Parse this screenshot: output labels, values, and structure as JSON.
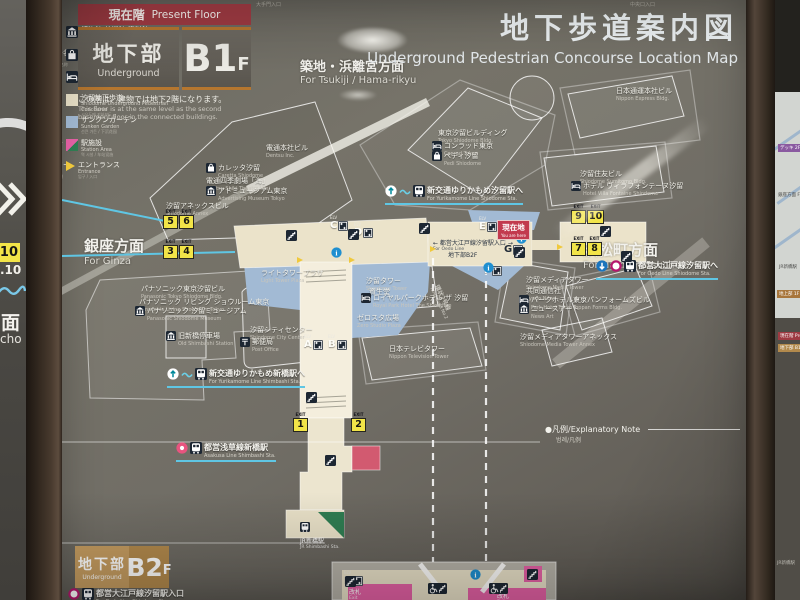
{
  "colors": {
    "concourse_beige": "#ebe3ca",
    "sunken_blue": "#a2bad4",
    "station_pink": "#e561a5",
    "jr_green": "#2f7d52",
    "exit_yellow": "#f2e448",
    "banner_red": "#9e3a42",
    "b2_tan": "#c59c60",
    "line_cyan": "#5fc6e4",
    "oedo_magenta": "#b5176d"
  },
  "sign": {
    "present_floor": {
      "jp": "現在階",
      "en": "Present Floor"
    },
    "floor_badge": {
      "name_jp": "地下部",
      "name_en": "Underground",
      "level": "B1",
      "suffix": "F"
    },
    "floor_note": {
      "jp": "この階は、建物では地下2階になります。",
      "en1": "This floor is at the same level as the second",
      "en2": "basement floor in the connected buildings."
    },
    "title": {
      "jp": "地下歩道案内図",
      "en": "Underground Pedestrian Concourse Location Map"
    },
    "b2_badge": {
      "name_jp": "地下部",
      "name_en": "Underground",
      "level": "B2",
      "suffix": "F"
    },
    "exit_tag": "EXIT",
    "elv_tag": "ELV"
  },
  "directions": [
    {
      "jp": "築地・浜離宮方面",
      "en": "For Tsukiji / Hama-rikyu",
      "x": 300,
      "y": 56,
      "size": 13
    },
    {
      "jp": "銀座方面",
      "en": "For Ginza",
      "x": 84,
      "y": 235,
      "size": 15
    },
    {
      "jp": "浜松町方面",
      "en": "For Hamamatsucho",
      "x": 583,
      "y": 239,
      "size": 15
    }
  ],
  "tiny_labels": [
    {
      "jp": "大手門入口",
      "x": 256,
      "y": 1
    },
    {
      "jp": "中央口入口",
      "x": 630,
      "y": 1
    }
  ],
  "buildings": [
    {
      "jp": "電通本社ビル",
      "en": "Dentsu Inc.",
      "x": 266,
      "y": 143
    },
    {
      "jp": "カレッタ汐留",
      "en": "Caretta Shiodome",
      "x": 206,
      "y": 163,
      "icon": "store"
    },
    {
      "jp": "電通四季劇場「海」",
      "en": "Dentsu Shiki Theatre Umi",
      "x": 206,
      "y": 176
    },
    {
      "jp": "アドミュージアム東京",
      "en": "Advertising Museum Tokyo",
      "x": 206,
      "y": 186,
      "icon": "museum"
    },
    {
      "jp": "汐留アネックスビル",
      "en": "Shiodome Annex",
      "x": 166,
      "y": 201
    },
    {
      "jp": "東京汐留ビルディング",
      "en": "Tokyo Shiodome Bldg.",
      "x": 438,
      "y": 128
    },
    {
      "jp": "コンラッド東京",
      "en": "Conrad Tokyo",
      "x": 432,
      "y": 141,
      "icon": "hotel"
    },
    {
      "jp": "ペディ汐留",
      "en": "Pedi Shiodome",
      "x": 432,
      "y": 151,
      "icon": "store"
    },
    {
      "jp": "日本通運本社ビル",
      "en": "Nippon Express Bldg.",
      "x": 616,
      "y": 86
    },
    {
      "jp": "汐留住友ビル",
      "en": "Shiodome Sumitomo Bldg.",
      "x": 580,
      "y": 169
    },
    {
      "jp": "ホテル ヴィラフォンテーヌ汐留",
      "en": "Hotel Villa Fontaine Shiodome",
      "x": 571,
      "y": 181,
      "icon": "hotel"
    },
    {
      "jp": "パナソニック東京汐留ビル",
      "en": "Panasonic Tokyo Shiodome Bldg.",
      "x": 141,
      "y": 284
    },
    {
      "jp": "パナソニック リビング ショウルーム東京",
      "en": "Panasonic Living Showroom Tokyo",
      "x": 139,
      "y": 297
    },
    {
      "jp": "パナソニック 汐留ミュージアム",
      "en": "Panasonic Shiodome Museum",
      "x": 135,
      "y": 306,
      "icon": "museum"
    },
    {
      "jp": "旧新橋停車場",
      "en": "Old Shimbashi Station",
      "x": 166,
      "y": 331,
      "icon": "museum"
    },
    {
      "jp": "汐留シティセンター",
      "en": "Shiodome City Center",
      "x": 250,
      "y": 325
    },
    {
      "jp": "郵便局",
      "en": "Post Office",
      "x": 240,
      "y": 337,
      "icon": "post"
    },
    {
      "jp": "ライトタワープラザ",
      "en": "Light Tower Plaza",
      "x": 261,
      "y": 268
    },
    {
      "jp": "汐留タワー",
      "en": "Shiodome Tower",
      "x": 366,
      "y": 276
    },
    {
      "jp": "資生堂",
      "en": "",
      "x": 369,
      "y": 287
    },
    {
      "jp": "ロイヤルパークホテル ザ 汐留",
      "en": "Royal Park Hotel The Shiodome",
      "x": 361,
      "y": 293,
      "icon": "hotel"
    },
    {
      "jp": "ゼロスタ広場",
      "en": "Zero Studio Plaza",
      "x": 357,
      "y": 313
    },
    {
      "jp": "日本テレビタワー",
      "en": "Nippon Television Tower",
      "x": 389,
      "y": 344
    },
    {
      "jp": "汐留メディアタワー",
      "en": "Shiodome Media Tower",
      "x": 526,
      "y": 275
    },
    {
      "jp": "共同通信社",
      "en": "Kyodo News",
      "x": 526,
      "y": 286
    },
    {
      "jp": "パークホテル東京",
      "en": "Park Hotel Tokyo",
      "x": 519,
      "y": 295,
      "icon": "hotel"
    },
    {
      "jp": "ニュースアート",
      "en": "News Art",
      "x": 519,
      "y": 304,
      "icon": "museum"
    },
    {
      "jp": "汐留メディアタワーアネックス",
      "en": "Shiodome Media Tower Annex",
      "x": 520,
      "y": 332
    },
    {
      "jp": "トッパンフォームズビル",
      "en": "Toppan Forms Bldg.",
      "x": 573,
      "y": 295
    }
  ],
  "transit": [
    {
      "jp": "新交通ゆりかもめ汐留駅へ",
      "en": "For Yurikamome Line Shiodome Sta.",
      "x": 385,
      "y": 185,
      "icons": [
        "upcircle",
        "wave",
        "train"
      ]
    },
    {
      "jp": "新交通ゆりかもめ新橋駅へ",
      "en": "For Yurikamome Line Shimbashi Sta.",
      "x": 167,
      "y": 368,
      "icons": [
        "upcircle",
        "wave",
        "train"
      ]
    },
    {
      "jp": "都営大江戸線汐留駅へ",
      "en": "For Oedo Line Shiodome Sta.",
      "x": 596,
      "y": 260,
      "icons": [
        "downcircle",
        "oedo",
        "train"
      ]
    },
    {
      "jp": "都営浅草線新橋駅",
      "en": "Asakusa Line Shimbashi Sta.",
      "x": 176,
      "y": 442,
      "icons": [
        "asakusa",
        "train"
      ]
    },
    {
      "jp": "都営大江戸線汐留駅入口",
      "en": "For Oedo Line Shiodome Sta.",
      "x": 68,
      "y": 588,
      "icons": [
        "oedo",
        "train"
      ]
    }
  ],
  "map_notes": [
    {
      "jp": "← 都営大江戸線汐留駅入口 →",
      "en": "For Oedo Line",
      "x": 433,
      "y": 238,
      "color": "#2a3442"
    },
    {
      "jp": "地下部B2F",
      "en": "",
      "x": 448,
      "y": 250,
      "color": "#2a3442"
    },
    {
      "jp": "JR新橋駅",
      "en": "JR Shimbashi Sta.",
      "x": 300,
      "y": 517,
      "color": "#ffffff",
      "icon": "train"
    },
    {
      "jp": "環状2号線",
      "en": "Ring Road No.2",
      "x": 441,
      "y": 283,
      "color": "#e8e6de",
      "rot": 64
    },
    {
      "jp": "改札",
      "en": "Exit",
      "x": 349,
      "y": 587,
      "color": "#ffffff"
    },
    {
      "jp": "改札",
      "en": "Exit",
      "x": 497,
      "y": 591,
      "color": "#ffffff"
    }
  ],
  "you_are_here": {
    "jp": "現在地",
    "en": "You are here",
    "x": 497,
    "y": 220
  },
  "exits": [
    {
      "nums": [
        "5",
        "6"
      ],
      "x": 163,
      "y": 210
    },
    {
      "nums": [
        "3",
        "4"
      ],
      "x": 163,
      "y": 240
    },
    {
      "nums": [
        "1"
      ],
      "x": 293,
      "y": 413
    },
    {
      "nums": [
        "2"
      ],
      "x": 351,
      "y": 413
    },
    {
      "nums": [
        "9",
        "10"
      ],
      "x": 571,
      "y": 205
    },
    {
      "nums": [
        "7",
        "8"
      ],
      "x": 571,
      "y": 237
    }
  ],
  "elevators": [
    {
      "label": "A",
      "x": 304,
      "y": 335
    },
    {
      "label": "B",
      "x": 328,
      "y": 335
    },
    {
      "label": "C",
      "x": 330,
      "y": 216
    },
    {
      "label": "D",
      "x": 354,
      "y": 223
    },
    {
      "label": "E",
      "x": 479,
      "y": 217
    },
    {
      "label": "F",
      "x": 484,
      "y": 261
    },
    {
      "label": "G",
      "x": 504,
      "y": 240,
      "dark": true
    },
    {
      "label": "D",
      "x": 344,
      "y": 571
    }
  ],
  "mini_icons": [
    {
      "t": "stairs",
      "x": 286,
      "y": 230
    },
    {
      "t": "stairs",
      "x": 348,
      "y": 229
    },
    {
      "t": "stairs",
      "x": 419,
      "y": 223
    },
    {
      "t": "stairs",
      "x": 514,
      "y": 247
    },
    {
      "t": "stairs",
      "x": 306,
      "y": 392
    },
    {
      "t": "stairs",
      "x": 325,
      "y": 455
    },
    {
      "t": "stairs",
      "x": 600,
      "y": 226
    },
    {
      "t": "stairs",
      "x": 621,
      "y": 251
    },
    {
      "t": "stairs",
      "x": 345,
      "y": 576
    },
    {
      "t": "stairs",
      "x": 436,
      "y": 583
    },
    {
      "t": "stairs",
      "x": 497,
      "y": 583
    },
    {
      "t": "stairs",
      "x": 527,
      "y": 569
    },
    {
      "t": "wheelchair",
      "x": 428,
      "y": 583
    },
    {
      "t": "wheelchair",
      "x": 489,
      "y": 583
    },
    {
      "t": "info",
      "x": 331,
      "y": 247
    },
    {
      "t": "info",
      "x": 483,
      "y": 262
    },
    {
      "t": "info",
      "x": 470,
      "y": 569
    },
    {
      "t": "info",
      "x": 516,
      "y": 233
    }
  ],
  "entrances": [
    {
      "x": 297,
      "y": 257
    },
    {
      "x": 349,
      "y": 257
    },
    {
      "x": 430,
      "y": 246
    },
    {
      "x": 557,
      "y": 244
    }
  ],
  "legend": {
    "bullet": "●",
    "header_jp": "凡例",
    "header_en": "Explanatory Note",
    "header_sub": "범례/凡例",
    "items_left": [
      {
        "icon": "exitlegend",
        "jp": "出口番号",
        "en": "Exit No.",
        "sub": "출구번호 / 出口号"
      },
      {
        "icon": "elvlegend",
        "jp": "エレベーター名称",
        "en": "Elevator Name",
        "sub": "엘리베이터 명칭 / 电梯名称"
      },
      {
        "icon": "subway",
        "jp": "地下鉄駅",
        "en": "Subway Station",
        "sub": "지하철역 / 地铁站"
      },
      {
        "icon": "train",
        "jp": "鉄道駅",
        "en": "Railway Station",
        "sub": "철도역 / 铁路车站"
      },
      {
        "icon": "stairs",
        "jp": "階段",
        "en": "Stairs",
        "sub": "계단 / 楼梯"
      },
      {
        "icon": "elevator",
        "jp": "エレベーター",
        "en": "Elevator",
        "sub": "엘리베이터 / 电梯"
      },
      {
        "icon": "escalator",
        "jp": "エスカレーター",
        "en": "Escalator",
        "sub": "에스컬레이터 / 自动扶梯"
      }
    ],
    "items_right": [
      {
        "icon": "museum",
        "jp": "博物館/美術館/資料館",
        "en": "Museum",
        "sub": "박물관 / 博物馆"
      },
      {
        "icon": "store",
        "jp": "大規模店舗",
        "en": "Department Store Bldg.",
        "sub": "백화점 / 大规模店铺"
      },
      {
        "icon": "hotel",
        "jp": "ホテル/宿泊施設",
        "en": "Hotel/Accommodation",
        "sub": "호텔 / 宾馆·住宿"
      },
      {
        "icon": "sw-concourse",
        "jp": "汐留地下歩道",
        "en": "Shiodome Underground Pedestrian Concourse",
        "sub": "시오도메 지하보도",
        "wide": true
      },
      {
        "icon": "sw-garden",
        "jp": "サンクンガーデン",
        "en": "Sunken Garden",
        "sub": "선큰 가든 / 下沉花园"
      },
      {
        "icon": "sw-station",
        "jp": "駅施設",
        "en": "Station Area",
        "sub": "역 시설 / 车站设施"
      },
      {
        "icon": "entrance",
        "jp": "エントランス",
        "en": "Entrance",
        "sub": "입구 / 入口"
      }
    ]
  },
  "side_left": {
    "exit_num": "10",
    "exit_sub": ".10",
    "kanji": "面",
    "roman": "cho"
  },
  "side_right": {
    "deck": "デッキ 2F",
    "ginza": "銀座方面 For Ginza",
    "jr": "JR新橋駅",
    "ground": "地上部 1F",
    "present": "現在階 Present Floor",
    "b1": "地下部 B1F",
    "bottom": "JR新橋駅"
  }
}
